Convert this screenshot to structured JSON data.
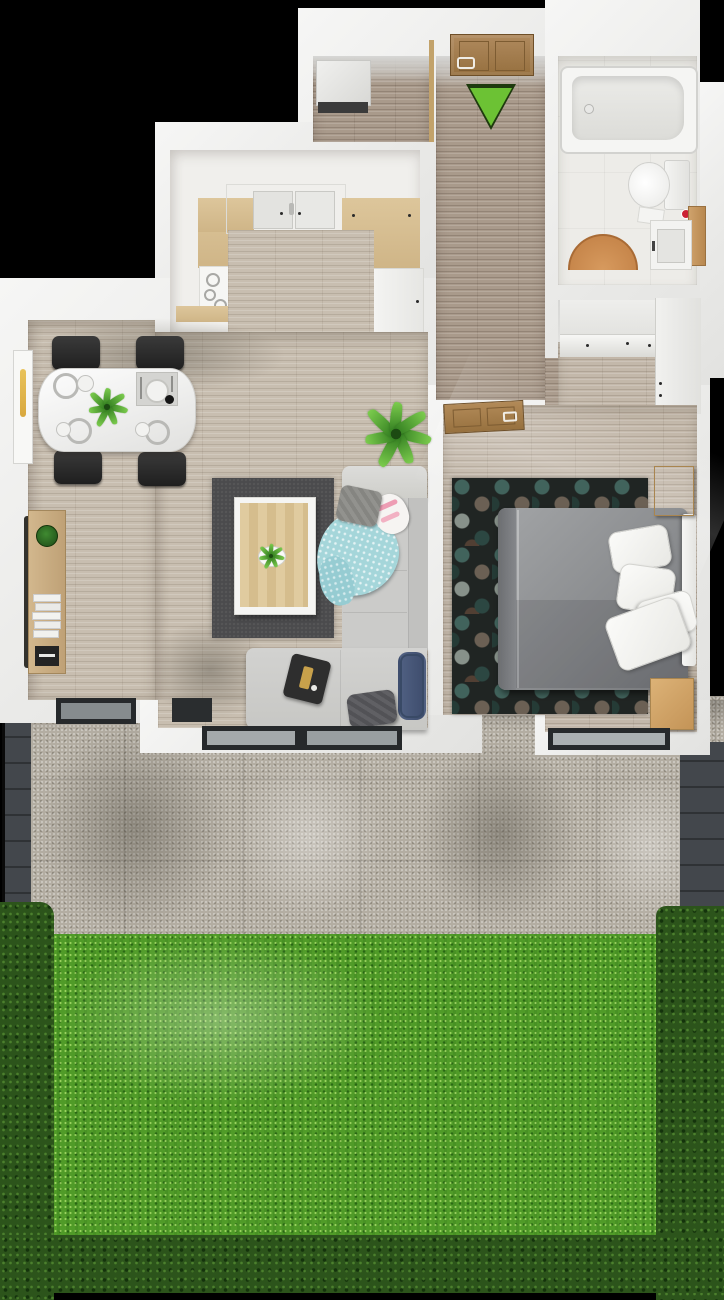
{
  "scene": {
    "type": "3d-floor-plan-top-down-render",
    "description": "One-bedroom apartment with kitchen, open living-dining room, bathroom, entry hall, rear terrace and fenced garden lawn",
    "orientation": "entrance at top, garden at bottom"
  },
  "entrance": {
    "marker": "green-arrow-pointing-down",
    "marker_color": "#6cc234",
    "door": "wooden-entry-door"
  },
  "rooms": [
    {
      "name": "entry-hall",
      "items": [
        "entry-door",
        "entrance-arrow",
        "white-cabinet",
        "wood-divider"
      ]
    },
    {
      "name": "corridor",
      "items": [
        "wood-plank-floor"
      ]
    },
    {
      "name": "bathroom",
      "items": [
        "bathtub",
        "toilet",
        "vanity-sink",
        "wood-side-panel",
        "red-toiletries",
        "half-round-bath-mat"
      ]
    },
    {
      "name": "kitchen",
      "items": [
        "double-sink-cabinet",
        "wood-counters",
        "cooktop",
        "white-base-cabinet",
        "appliance"
      ]
    },
    {
      "name": "dining-area",
      "items": [
        "white-dining-table",
        "four-black-chairs",
        "plates",
        "bowls",
        "placemat",
        "table-plant",
        "side-window",
        "bookshelf-with-plant-and-books"
      ]
    },
    {
      "name": "living-room",
      "items": [
        "dark-gray-rug",
        "wood-coffee-table",
        "small-plant",
        "corner-sofa",
        "teal-blanket",
        "pink-blanket",
        "gray-pillow",
        "dark-pillow",
        "navy-bolster",
        "serving-tray",
        "tall-floor-plant"
      ]
    },
    {
      "name": "bedroom",
      "items": [
        "double-bed-gray",
        "white-pillows",
        "headboard",
        "hexagon-pattern-rug",
        "nightstand-top",
        "nightstand-bottom",
        "open-wood-door",
        "dresser",
        "wardrobe"
      ]
    },
    {
      "name": "terrace",
      "items": [
        "concrete-pavers",
        "sliding-glass-door",
        "dining-terrace-door",
        "bedroom-window",
        "left-fence",
        "right-fence"
      ]
    },
    {
      "name": "garden",
      "items": [
        "bright-lawn",
        "hedge-border-left",
        "hedge-border-right",
        "hedge-border-bottom"
      ]
    }
  ],
  "colors": {
    "background": "#000000",
    "walls": "#ebebe9",
    "living_wood_floor": "#c8beb0",
    "corridor_wood_floor": "#a99a8b",
    "bedroom_wood_floor": "#c3b8aa",
    "kitchen_counter_wood": "#d5bb8f",
    "accent_green_arrow": "#6cc234",
    "lawn_green": "#509b28",
    "hedge_green": "#2c541b",
    "terrace_concrete": "#b3ada2",
    "living_rug": "#4b4b4d",
    "sofa": "#cbcbc9",
    "bed": "#8b8d8f",
    "nightstand_wood": "#d3a86f",
    "bath_mat": "#cd8f55",
    "door_wood": "#a6825a",
    "fence": "#43474c",
    "window_glass": "#a4a9ab",
    "frame_dark": "#26292b"
  }
}
